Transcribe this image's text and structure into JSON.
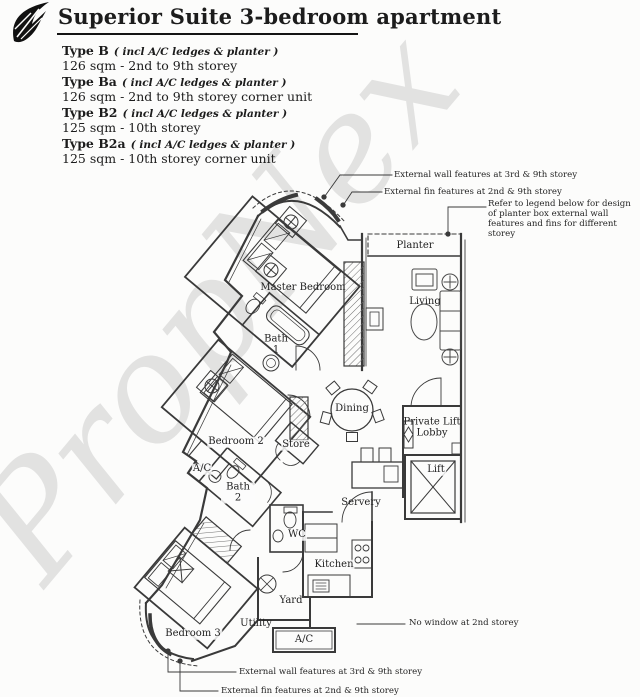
{
  "header": {
    "title": "Superior Suite 3-bedroom apartment",
    "logo": "leaf-logo-icon"
  },
  "types": [
    {
      "name": "Type B",
      "note": "( incl A/C ledges & planter )",
      "size": "126 sqm - 2nd to 9th storey"
    },
    {
      "name": "Type Ba",
      "note": "( incl A/C ledges & planter )",
      "size": "126 sqm - 2nd to 9th storey corner unit"
    },
    {
      "name": "Type B2",
      "note": "( incl A/C ledges & planter )",
      "size": "125 sqm - 10th storey"
    },
    {
      "name": "Type B2a",
      "note": "( incl A/C ledges & planter )",
      "size": "125 sqm - 10th storey corner unit"
    }
  ],
  "plan": {
    "watermark": "PropNex",
    "rooms": [
      {
        "label": "Master Bedroom"
      },
      {
        "label": "Bath 1"
      },
      {
        "label": "Planter"
      },
      {
        "label": "Living"
      },
      {
        "label": "Dining"
      },
      {
        "label": "Store"
      },
      {
        "label": "Private Lift Lobby"
      },
      {
        "label": "Lift"
      },
      {
        "label": "Bedroom 2"
      },
      {
        "label": "A/C"
      },
      {
        "label": "Bath 2"
      },
      {
        "label": "Servery"
      },
      {
        "label": "WC"
      },
      {
        "label": "Kitchen"
      },
      {
        "label": "Yard"
      },
      {
        "label": "Utility"
      },
      {
        "label": "Bedroom 3"
      },
      {
        "label": "A/C"
      }
    ],
    "annotations": [
      {
        "text": "External wall features at 3rd & 9th storey"
      },
      {
        "text": "External fin features at 2nd & 9th storey"
      },
      {
        "text": "Refer to legend below for design of planter box external wall features and fins for different storey"
      },
      {
        "text": "No window at 2nd storey"
      },
      {
        "text": "External wall features at 3rd & 9th storey"
      },
      {
        "text": "External fin features at 2nd & 9th storey"
      }
    ]
  }
}
